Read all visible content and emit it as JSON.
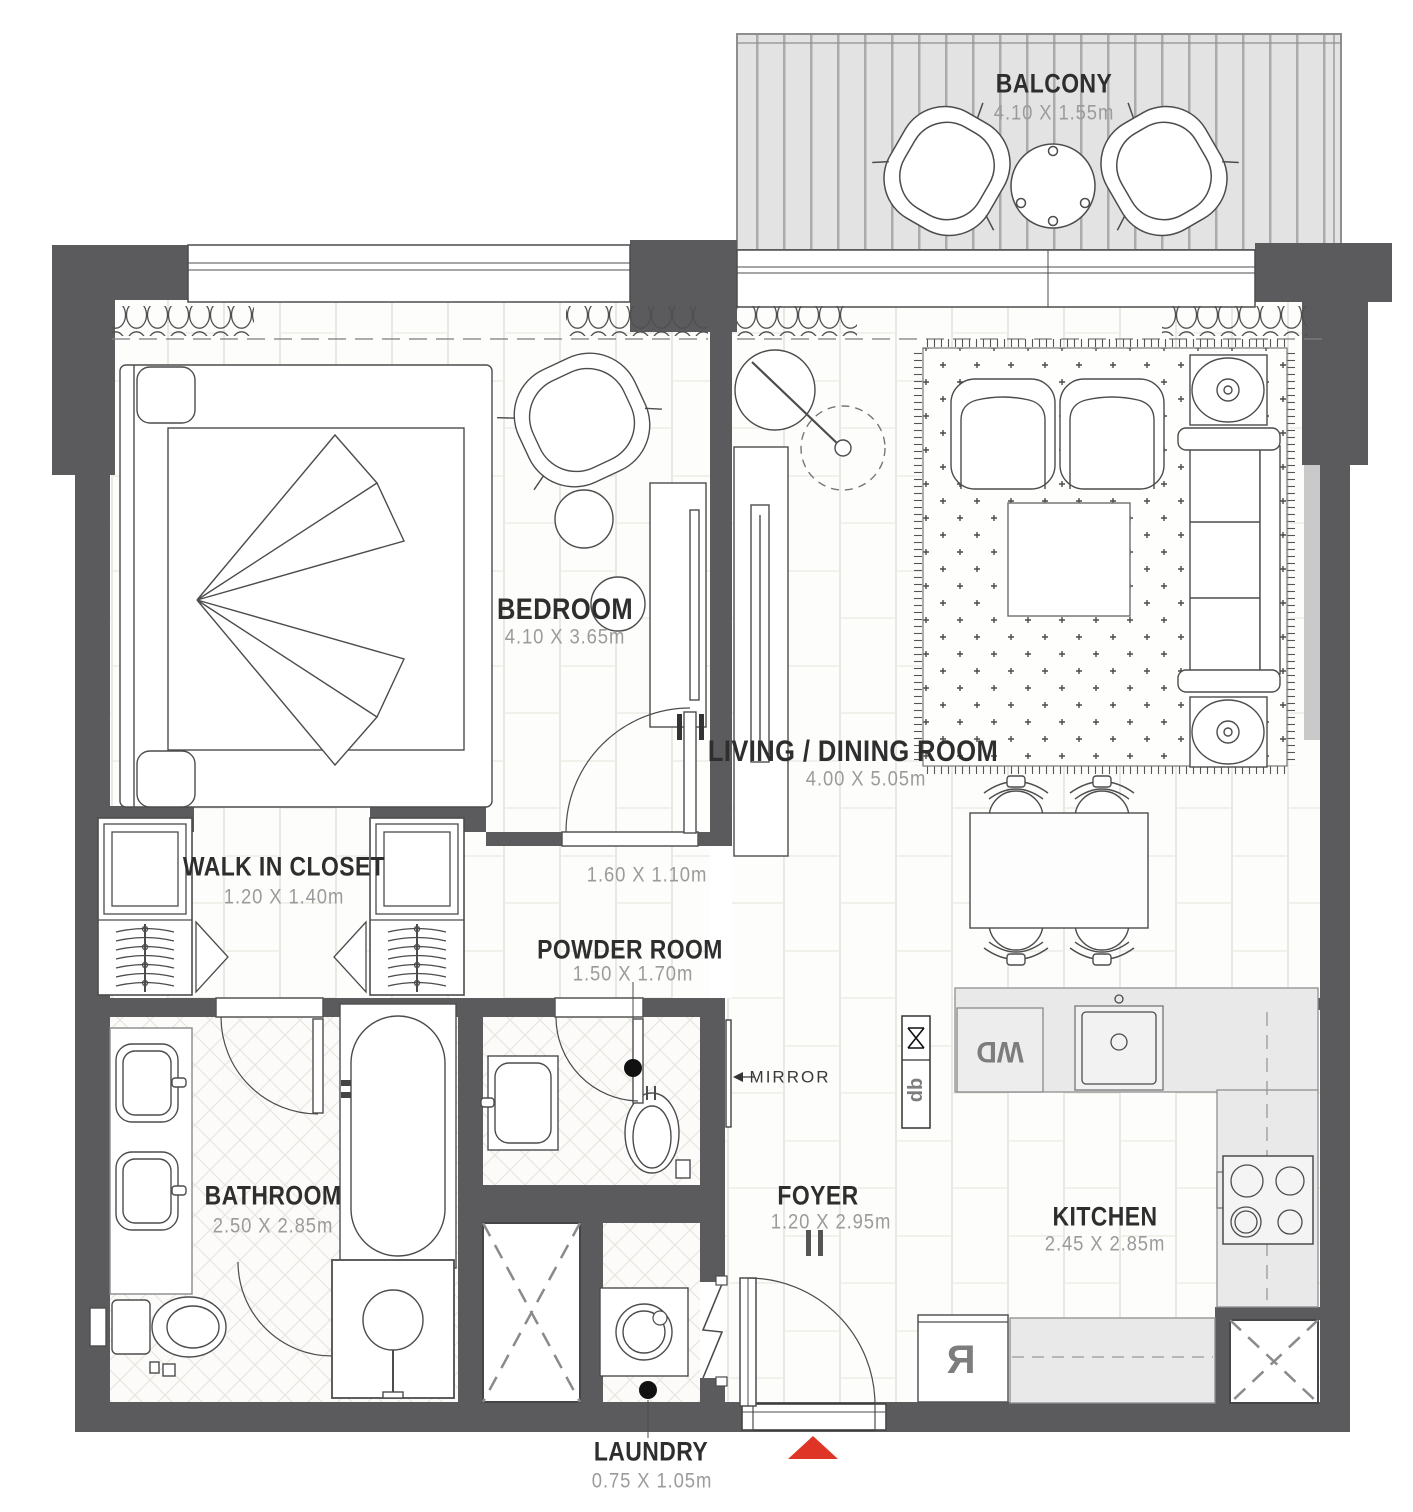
{
  "rooms": {
    "balcony": {
      "label": "BALCONY",
      "dims": "4.10 X 1.55m"
    },
    "bedroom": {
      "label": "BEDROOM",
      "dims": "4.10 X 3.65m"
    },
    "living_dining": {
      "label": "LIVING / DINING ROOM",
      "dims": "4.00 X 5.05m"
    },
    "walk_in_closet": {
      "label": "WALK IN CLOSET",
      "dims": "1.20 X 1.40m"
    },
    "powder_room": {
      "label": "POWDER ROOM",
      "dims": "1.50 X 1.70m"
    },
    "bathroom": {
      "label": "BATHROOM",
      "dims": "2.50 X 2.85m"
    },
    "foyer": {
      "label": "FOYER",
      "dims": "1.20 X 2.95m"
    },
    "kitchen": {
      "label": "KITCHEN",
      "dims": "2.45 X 2.85m"
    },
    "laundry": {
      "label": "LAUNDRY",
      "dims": "0.75 X 1.05m"
    }
  },
  "annotations": {
    "hall_dims": "1.60 X 1.10m",
    "mirror": "MIRROR"
  },
  "appliances": {
    "washer_dryer": "WD",
    "distribution_board": "db",
    "refrigerator": "R"
  },
  "colors": {
    "wall": "#5b5b5d",
    "wall_light": "#c9c9c9",
    "line": "#4c4c4c",
    "label": "#2e2e2e",
    "dim": "#9b9b9b",
    "counter": "#e9e9e9",
    "counter_border": "#8f8f8f",
    "entrance_red": "#df3526",
    "floor_joint": "#e8e5df",
    "balcony_bg": "#e3e3e3",
    "balcony_stripe": "#b0b0b0",
    "rug_dot": "#4a4a4a"
  }
}
